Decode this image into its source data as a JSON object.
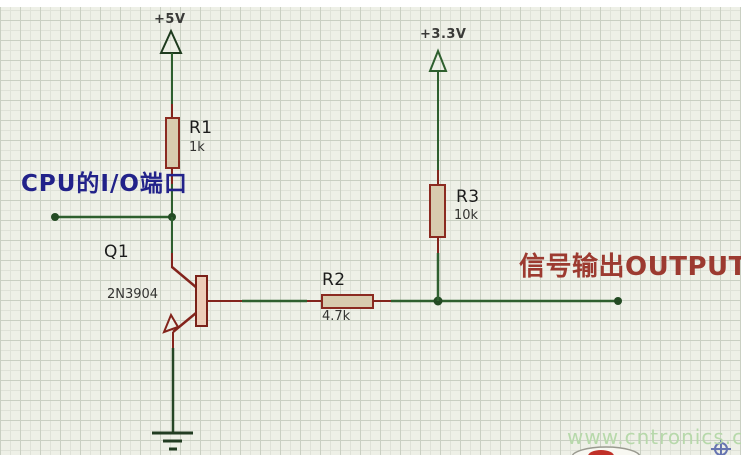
{
  "canvas": {
    "width": 755,
    "height": 455,
    "background": "#eef0e7"
  },
  "colors": {
    "grid_minor": "#dfe2d8",
    "grid_major": "#c9cfc2",
    "wire_green": "#2e5f2e",
    "pin_red": "#83241c",
    "junction_green": "#234a23",
    "resistor_fill": "#d8cbae",
    "resistor_border": "#8b2a20",
    "transistor_fill": "#edcdb8",
    "transistor_border": "#7a2018",
    "power_symbol_green": "#2a522a",
    "ground_dark": "#223c22",
    "annotation_blue": "#22228a",
    "annotation_red": "#9c3a30",
    "watermark_green": "#b5d8a8",
    "origin_marker_blue": "#5060a8"
  },
  "power": {
    "vcc5": {
      "label": "+5V"
    },
    "vcc33": {
      "label": "+3.3V"
    }
  },
  "components": {
    "r1": {
      "ref": "R1",
      "value": "1k"
    },
    "r2": {
      "ref": "R2",
      "value": "4.7k"
    },
    "r3": {
      "ref": "R3",
      "value": "10k"
    },
    "q1": {
      "ref": "Q1",
      "value": "2N3904"
    }
  },
  "annotations": {
    "input_label": "CPU的I/O端口",
    "output_label": "信号输出OUTPUT"
  },
  "watermark": {
    "text": "www.cntronics.com"
  }
}
